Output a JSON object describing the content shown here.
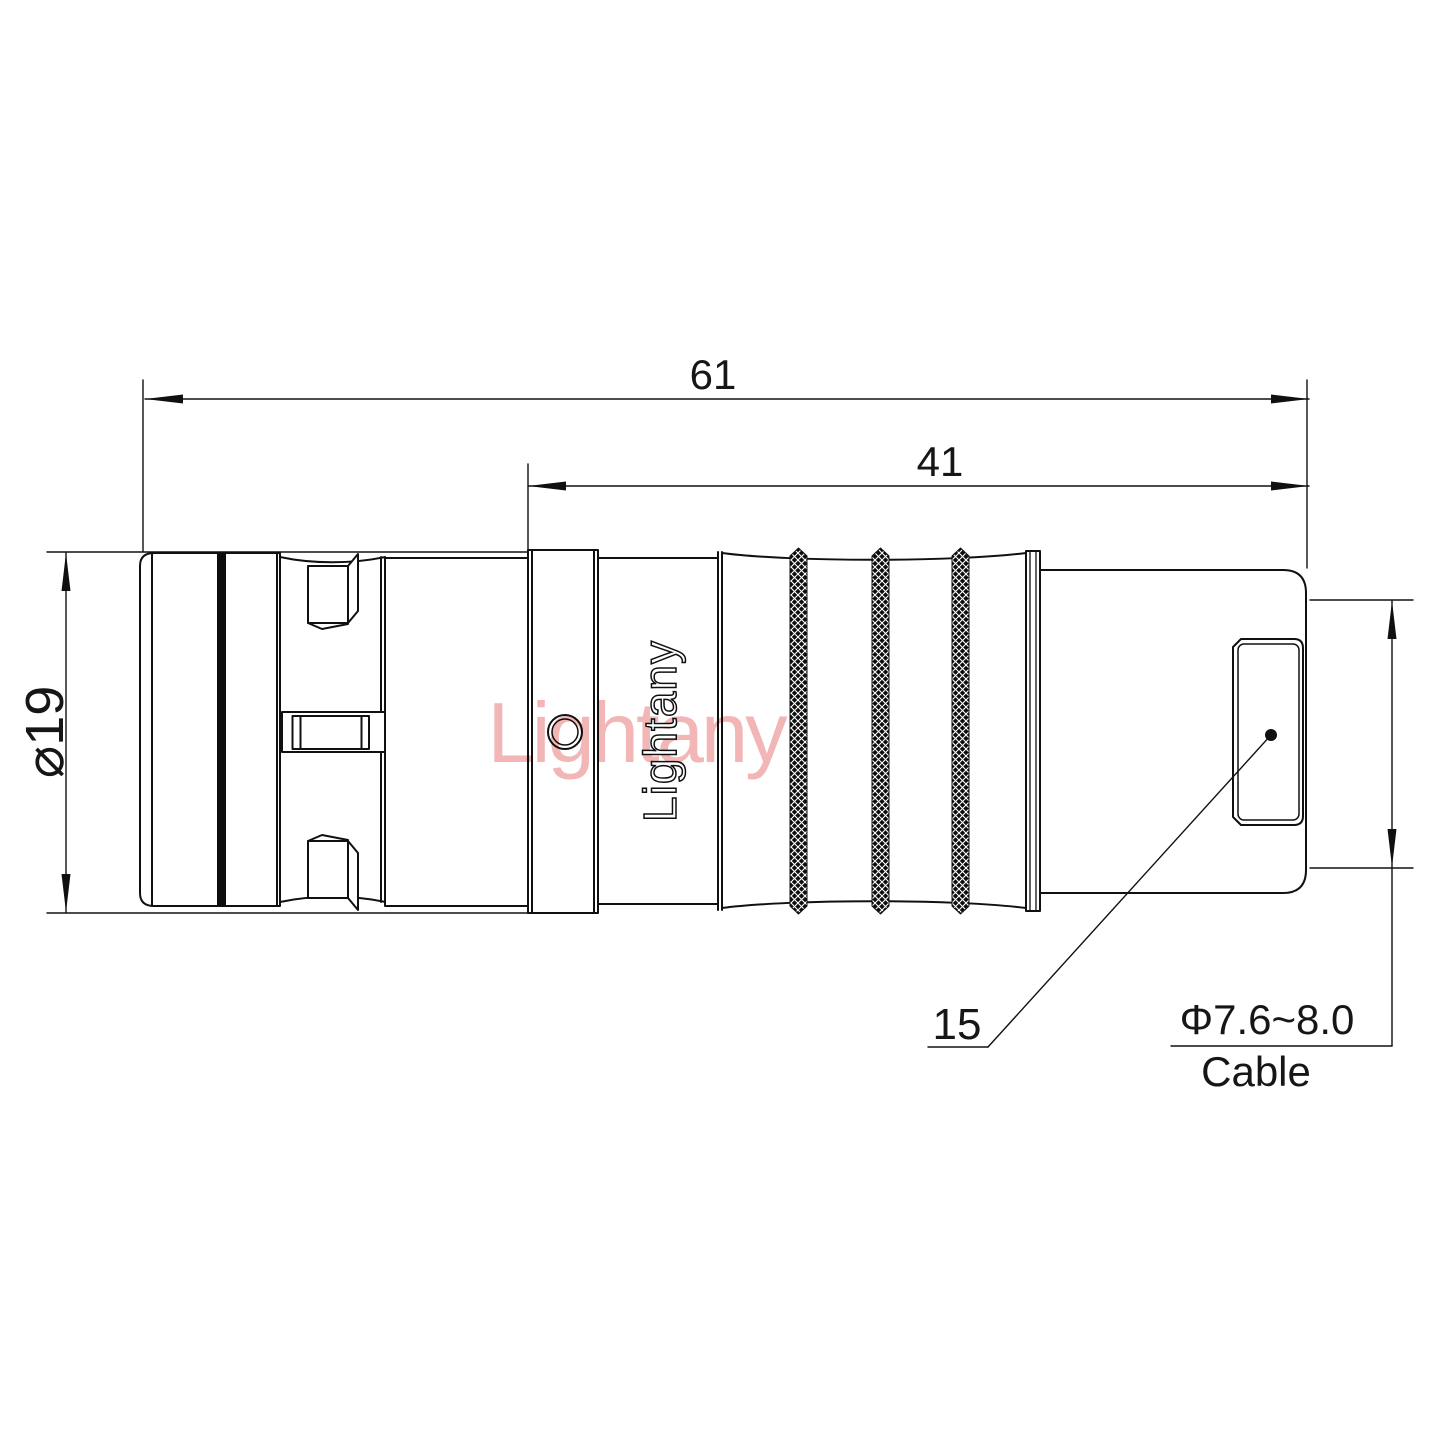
{
  "drawing": {
    "background": "#ffffff",
    "line_color": "#101010",
    "watermark": {
      "text": "Lightany",
      "color": "#f2b6b6"
    },
    "part": {
      "brand": "Lightany"
    },
    "dims": {
      "overall_length": "61",
      "rear_length": "41",
      "diameter": "⌀19",
      "nut_size": "15",
      "cable_diameter": "Φ7.6~8.0",
      "cable_caption": "Cable"
    }
  }
}
